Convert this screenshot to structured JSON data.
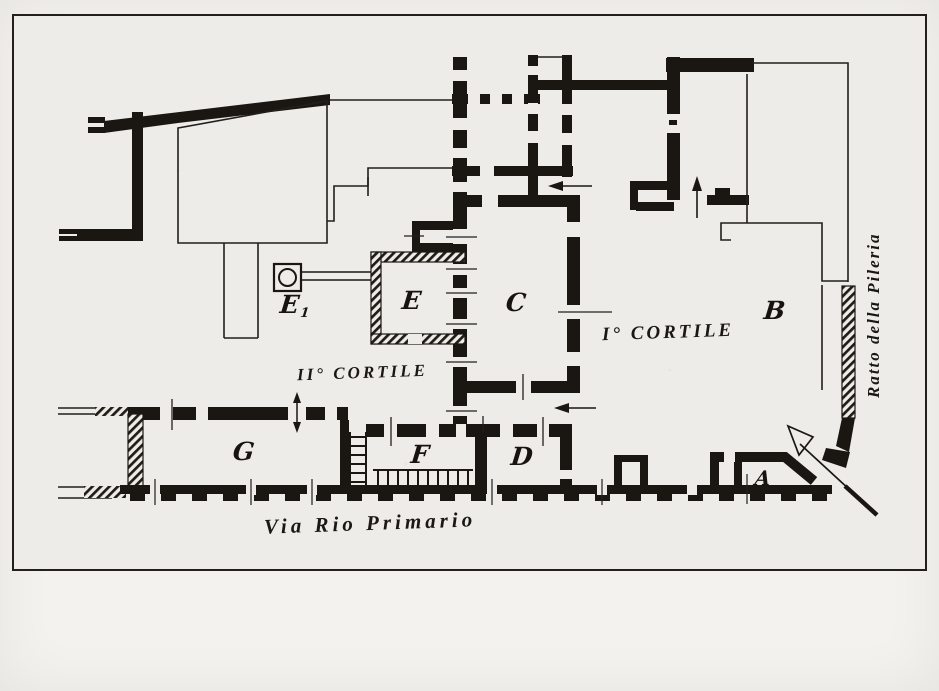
{
  "plan": {
    "rooms": [
      {
        "id": "A",
        "label": "A"
      },
      {
        "id": "B",
        "label": "B"
      },
      {
        "id": "C",
        "label": "C"
      },
      {
        "id": "D",
        "label": "D"
      },
      {
        "id": "E",
        "label": "E"
      },
      {
        "id": "E1",
        "label": "E",
        "sub": "1"
      },
      {
        "id": "F",
        "label": "F"
      },
      {
        "id": "G",
        "label": "G"
      }
    ],
    "areas": {
      "courtyard_first": "I° CORTILE",
      "courtyard_second": "II° CORTILE"
    },
    "streets": {
      "bottom": "Via Rio Primario",
      "right": "Ratto della Pileria"
    },
    "symbols": {
      "well": "well-with-channel",
      "north_arrow": "orientation-arrow",
      "stairs": "stair-ladder",
      "colonnade": "column-row"
    },
    "colors": {
      "ink": "#1a1713",
      "paper": "#edece8",
      "margin": "#f3f2ef"
    }
  }
}
